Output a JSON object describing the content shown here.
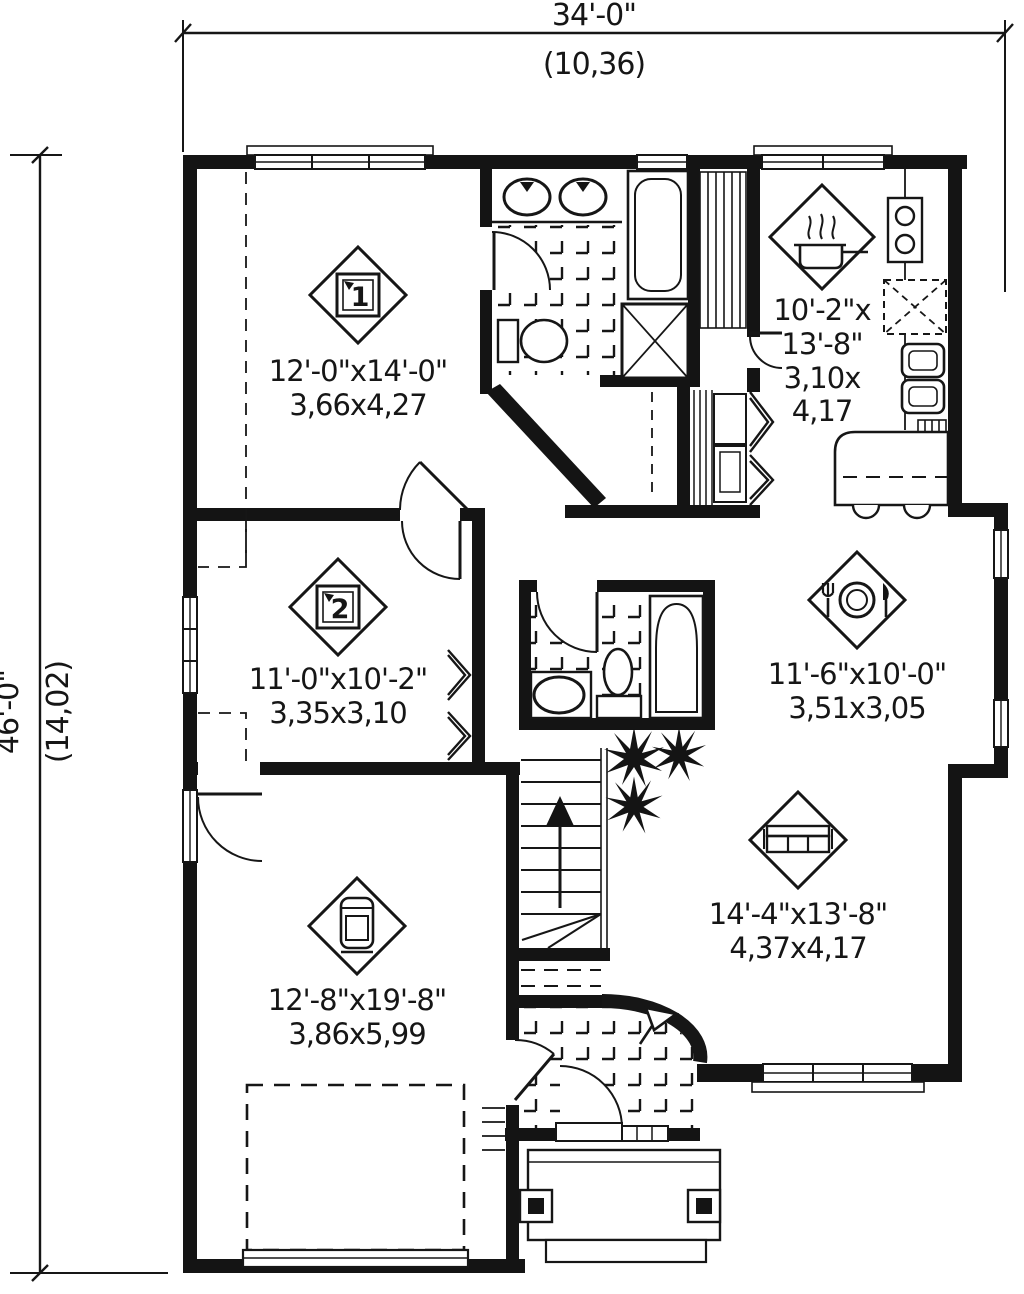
{
  "drawing": {
    "title": "house-floor-plan",
    "colors": {
      "ink": "#161616",
      "paper": "#ffffff"
    },
    "dimensions": {
      "top": {
        "imperial": "34'-0\"",
        "metric": "(10,36)"
      },
      "left": {
        "imperial": "46'-0\"",
        "metric": "(14,02)"
      }
    },
    "rooms": [
      {
        "id": "bedroom-1",
        "marker": "1",
        "icon": "bed-number-1-marker",
        "line1": "12'-0\"x14'-0\"",
        "line2": "3,66x4,27"
      },
      {
        "id": "bedroom-2",
        "marker": "2",
        "icon": "bed-number-2-marker",
        "line1": "11'-0\"x10'-2\"",
        "line2": "3,35x3,10"
      },
      {
        "id": "kitchen",
        "marker": "",
        "icon": "cooking-pot-icon",
        "line1": "10'-2\"x",
        "line2": "13'-8\"",
        "line3": "3,10x",
        "line4": "4,17"
      },
      {
        "id": "dining",
        "marker": "",
        "icon": "dining-plate-icon",
        "line1": "11'-6\"x10'-0\"",
        "line2": "3,51x3,05"
      },
      {
        "id": "living",
        "marker": "",
        "icon": "sofa-icon",
        "line1": "14'-4\"x13'-8\"",
        "line2": "4,37x4,17"
      },
      {
        "id": "garage",
        "marker": "",
        "icon": "car-icon",
        "line1": "12'-8\"x19'-8\"",
        "line2": "3,86x5,99"
      }
    ],
    "symbols": [
      "up-arrow-stairs",
      "entry-flag-marker",
      "plant-starburst",
      "shower-x",
      "fridge-x-dashed"
    ]
  }
}
